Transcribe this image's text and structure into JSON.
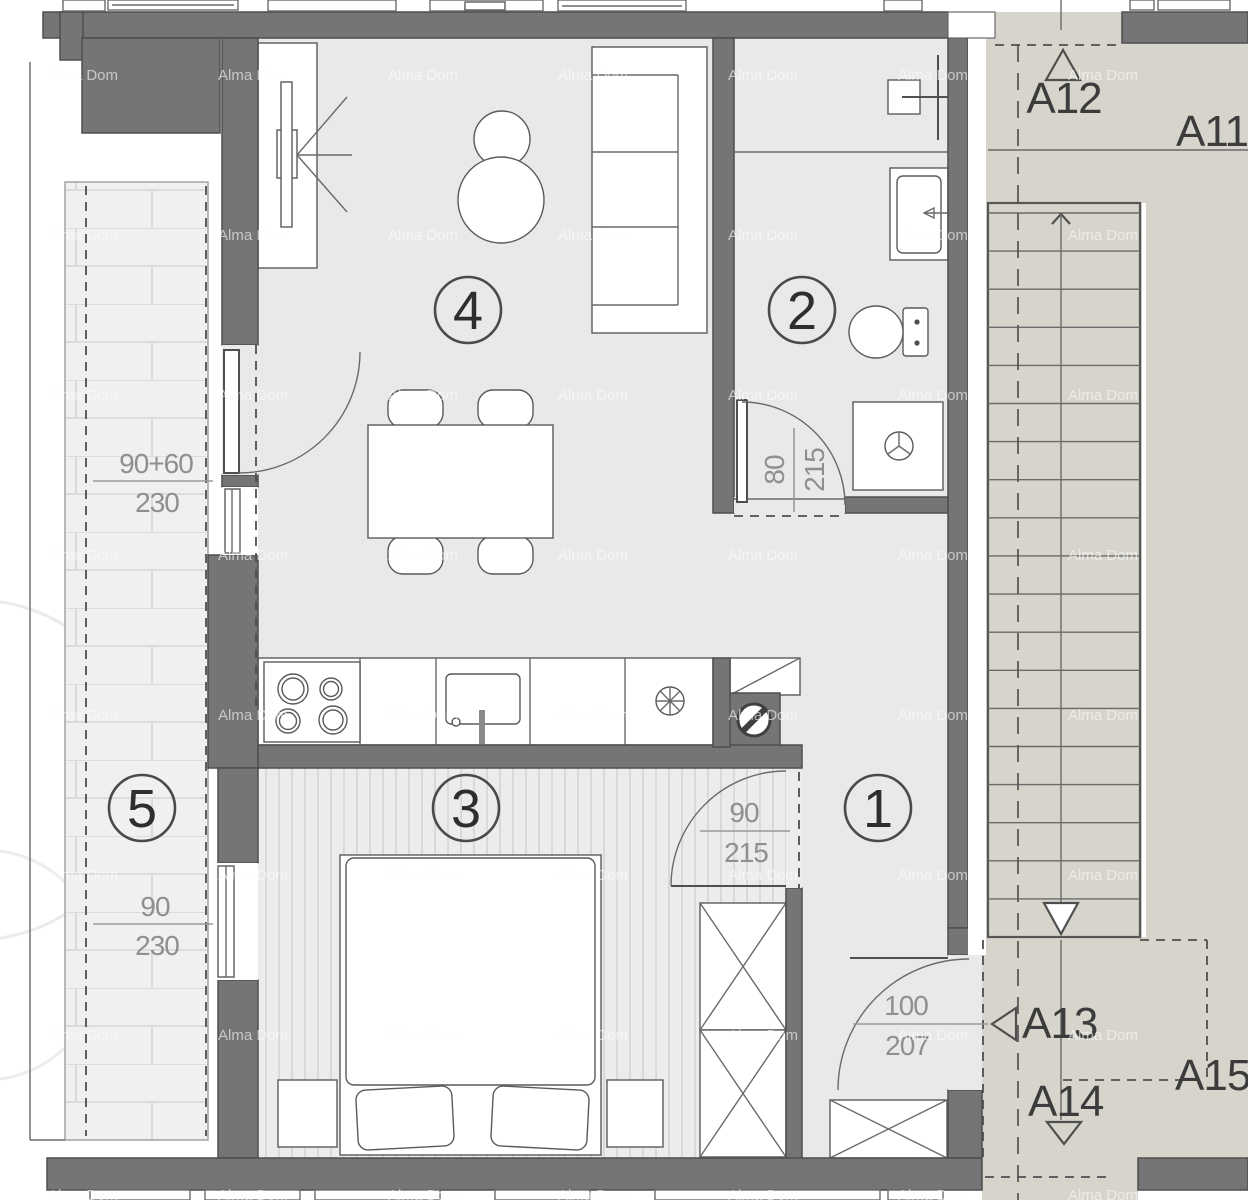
{
  "title": "Apartment floor plan",
  "watermark": {
    "text": "Alma Dom"
  },
  "colors": {
    "wall": "#757575",
    "floor": "#e9e9e9",
    "stair_area": "#d6d4cb",
    "balcony": "#f0f0f0",
    "bedroom_floor": "#ececec",
    "outline": "#4f4f4f",
    "dimension_text": "#8f8f8f",
    "label_text": "#3c3c3c"
  },
  "rooms": [
    {
      "id": "hallway",
      "number": "1"
    },
    {
      "id": "bathroom",
      "number": "2"
    },
    {
      "id": "bedroom",
      "number": "3"
    },
    {
      "id": "living-room",
      "number": "4"
    },
    {
      "id": "balcony",
      "number": "5"
    }
  ],
  "unit_labels": [
    {
      "id": "a11",
      "text": "A11"
    },
    {
      "id": "a12",
      "text": "A12"
    },
    {
      "id": "a13",
      "text": "A13"
    },
    {
      "id": "a14",
      "text": "A14"
    },
    {
      "id": "a15",
      "text": "A15"
    }
  ],
  "dimensions": [
    {
      "id": "balcony-door-window",
      "width": "90+60",
      "height": "230"
    },
    {
      "id": "balcony-bedroom-window",
      "width": "90",
      "height": "230"
    },
    {
      "id": "bathroom-door",
      "width": "80",
      "height": "215"
    },
    {
      "id": "bedroom-door",
      "width": "90",
      "height": "215"
    },
    {
      "id": "entrance-door",
      "width": "100",
      "height": "207"
    }
  ],
  "stairs": {
    "treads": 19
  }
}
